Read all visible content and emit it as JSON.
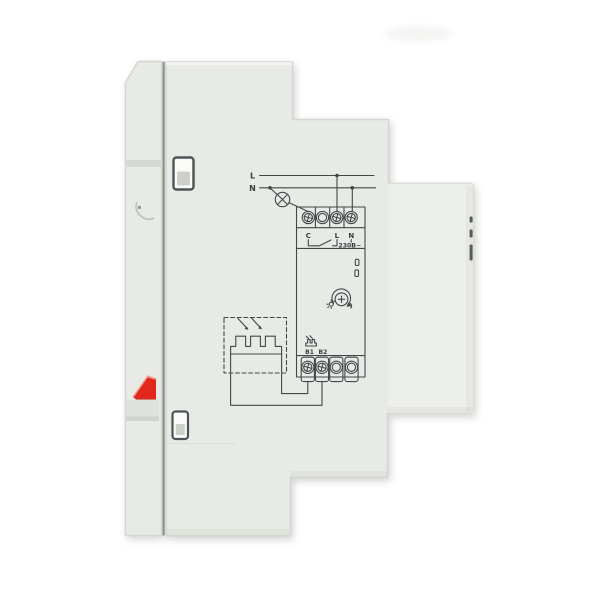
{
  "photo": {
    "subject": "din-rail-photo-relay-side-view",
    "colors": {
      "background": "#ffffff",
      "body": "#e8ebe5",
      "body_light": "#eef0eb",
      "body_shade": "#dfe2dc",
      "outline": "#d3d7d0",
      "seam": "#888c86",
      "slot_stroke": "#4f5355",
      "slot_fill": "#fafbf9",
      "slot_inner": "#ccd0c9",
      "lever_red": "#e1281b",
      "lever_highlight": "#f59d93",
      "vent_dark": "#585c58",
      "diagram_line": "#43474a"
    }
  },
  "diagram": {
    "supply": {
      "live": "L",
      "neutral": "N"
    },
    "terminals_top": {
      "c": "C",
      "l": "L",
      "n": "N"
    },
    "voltage": "230В~",
    "terminals_bottom": {
      "b1": "В1",
      "b2": "В2"
    },
    "icons": {
      "lamp": "lamp-circle-x-icon",
      "relay_contact": "switch-contact-icon",
      "leds": "led-indicator-icons",
      "dial": "rotary-adjust-dial-icon",
      "sun": "sun-icon",
      "rotate_arrow": "rotate-arrow-icon",
      "photocell": "photocell-resistor-icon",
      "light_arrows": "light-rays-arrows-icon",
      "sensor_box": "external-sensor-dashed-box",
      "screws": "phillips-screw-terminal-icon"
    }
  }
}
